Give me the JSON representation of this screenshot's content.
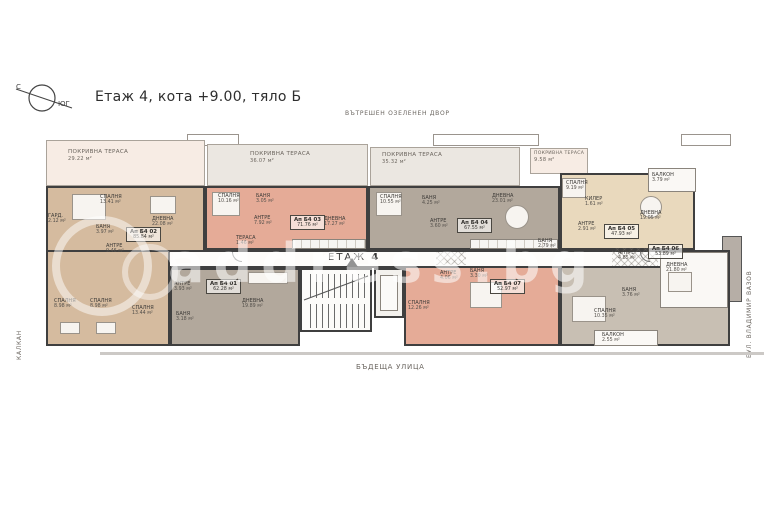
{
  "page": {
    "title": "Етаж 4, кота +9.00, тяло Б"
  },
  "compass": {
    "north_label": "С",
    "south_label": "ЮГ"
  },
  "surroundings": {
    "top": "ВЪТРЕШЕН ОЗЕЛЕНЕН ДВОР",
    "bottom": "БЪДЕЩА УЛИЦА",
    "left": "КАЛКАН",
    "right": "БУЛ. ВЛАДИМИР ВАЗОВ"
  },
  "corridor": {
    "floor_word": "ЕТАЖ",
    "floor_number": "4"
  },
  "watermark": {
    "text": "address.bg"
  },
  "terraces": [
    {
      "name": "ПОКРИВНА ТЕРАСА",
      "area": "29.22 м²"
    },
    {
      "name": "ПОКРИВНА ТЕРАСА",
      "area": "36.07 м²"
    },
    {
      "name": "ПОКРИВНА ТЕРАСА",
      "area": "35.32 м²"
    },
    {
      "name": "ПОКРИВНА ТЕРАСА",
      "area": "9.58 м²"
    }
  ],
  "apartments": [
    {
      "id": "Ап Б4 01",
      "area": "62.28 м²"
    },
    {
      "id": "Ап Б4 02",
      "area": "85.84 м²"
    },
    {
      "id": "Ап Б4 03",
      "area": "71.76 м²"
    },
    {
      "id": "Ап Б4 04",
      "area": "67.55 м²"
    },
    {
      "id": "Ап Б4 05",
      "area": "47.93 м²"
    },
    {
      "id": "Ап Б4 06",
      "area": "53.89 м²"
    },
    {
      "id": "Ап Б4 07",
      "area": "52.97 м²"
    }
  ],
  "rooms": [
    {
      "name": "СПАЛНЯ",
      "area": "13.41 м²"
    },
    {
      "name": "ДНЕВНА",
      "area": "22.08 м²"
    },
    {
      "name": "БАНЯ",
      "area": "3.97 м²"
    },
    {
      "name": "ГАРД.",
      "area": "2.12 м²"
    },
    {
      "name": "АНТРЕ",
      "area": "9.46 м²"
    },
    {
      "name": "СПАЛНЯ",
      "area": "10.16 м²"
    },
    {
      "name": "БАНЯ",
      "area": "3.05 м²"
    },
    {
      "name": "АНТРЕ",
      "area": "7.92 м²"
    },
    {
      "name": "ДНЕВНА",
      "area": "17.27 м²"
    },
    {
      "name": "ТЕРАСА",
      "area": "1.46 м²"
    },
    {
      "name": "СПАЛНЯ",
      "area": "10.55 м²"
    },
    {
      "name": "БАНЯ",
      "area": "4.25 м²"
    },
    {
      "name": "АНТРЕ",
      "area": "3.60 м²"
    },
    {
      "name": "ДНЕВНА",
      "area": "23.01 м²"
    },
    {
      "name": "БАНЯ",
      "area": "2.79 м²"
    },
    {
      "name": "СПАЛНЯ",
      "area": "9.19 м²"
    },
    {
      "name": "КИЛЕР",
      "area": "1.61 м²"
    },
    {
      "name": "ДНЕВНА",
      "area": "19.05 м²"
    },
    {
      "name": "АНТРЕ",
      "area": "2.91 м²"
    },
    {
      "name": "БАЛКОН",
      "area": "3.79 м²"
    },
    {
      "name": "АНТРЕ",
      "area": "4.85 м²"
    },
    {
      "name": "ДНЕВНА",
      "area": "21.80 м²"
    },
    {
      "name": "СПАЛНЯ",
      "area": "10.35 м²"
    },
    {
      "name": "БАНЯ",
      "area": "3.76 м²"
    },
    {
      "name": "БАЛКОН",
      "area": "2.55 м²"
    },
    {
      "name": "СПАЛНЯ",
      "area": "8.98 м²"
    },
    {
      "name": "СПАЛНЯ",
      "area": "8.98 м²"
    },
    {
      "name": "СПАЛНЯ",
      "area": "13.44 м²"
    },
    {
      "name": "АНТРЕ",
      "area": "3.93 м²"
    },
    {
      "name": "БАНЯ",
      "area": "3.18 м²"
    },
    {
      "name": "ДНЕВНА",
      "area": "19.89 м²"
    },
    {
      "name": "СПАЛНЯ",
      "area": "12.26 м²"
    },
    {
      "name": "АНТРЕ",
      "area": "4.06 м²"
    },
    {
      "name": "БАНЯ",
      "area": "3.30 м²"
    }
  ],
  "colors": {
    "wall": "#3f3f3f",
    "unit_tan": "#d5bb9f",
    "unit_salmon": "#e5ab97",
    "unit_gray": "#b2a89c",
    "unit_beige": "#e9d9bd",
    "unit_graylight": "#c8bfb3",
    "terrace_cream": "#f7ece4",
    "terrace_gray": "#ebe7e1"
  }
}
